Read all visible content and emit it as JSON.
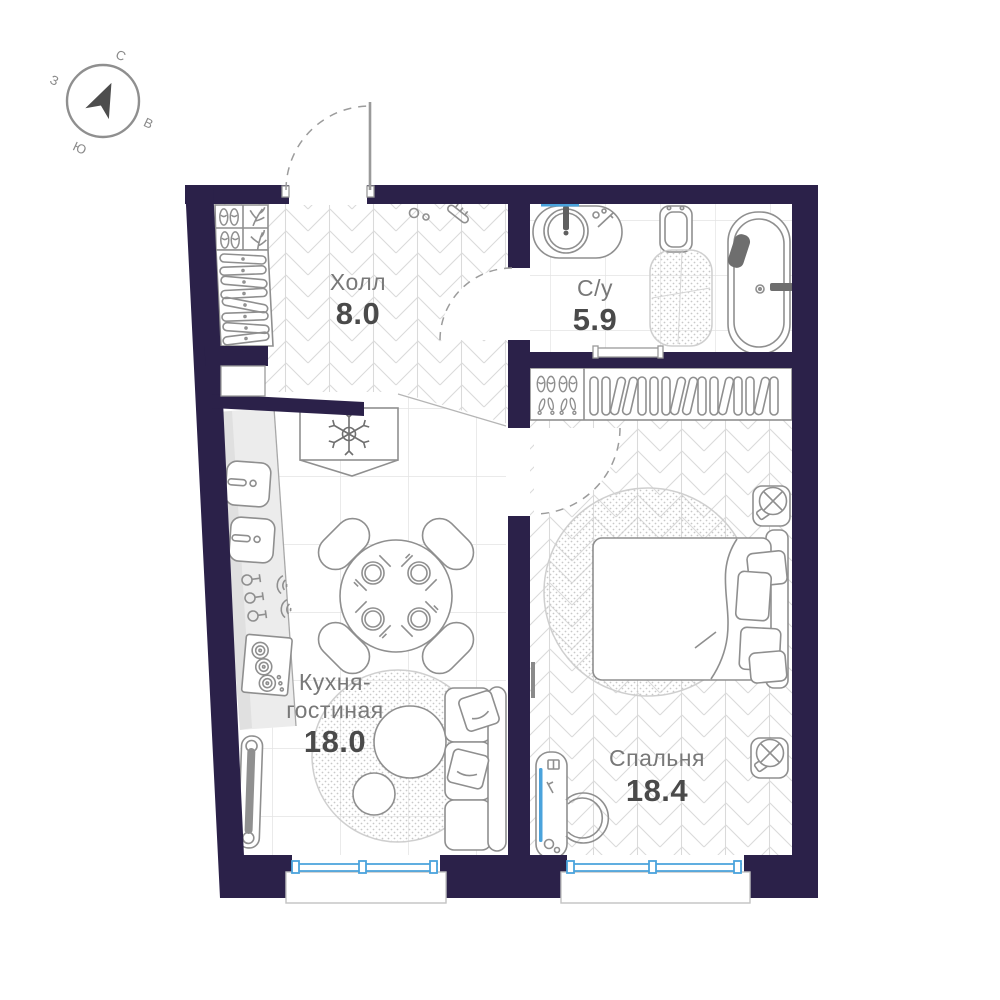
{
  "plan": {
    "compass": {
      "north": "С",
      "east": "В",
      "south": "Ю",
      "west": "З"
    },
    "rooms": {
      "hall": {
        "name": "Холл",
        "area": "8.0"
      },
      "bathroom": {
        "name": "С/у",
        "area": "5.9"
      },
      "kitchen_living": {
        "name_line1": "Кухня-",
        "name_line2": "гостиная",
        "area": "18.0"
      },
      "bedroom": {
        "name": "Спальня",
        "area": "18.4"
      }
    },
    "colors": {
      "wall": "#2b2149",
      "accent_blue": "#4aa3dc",
      "furniture_line": "#8f8f8f",
      "floor_pattern_line": "#dadada",
      "room_label": "#787878",
      "area_label": "#4a4a4a"
    }
  }
}
